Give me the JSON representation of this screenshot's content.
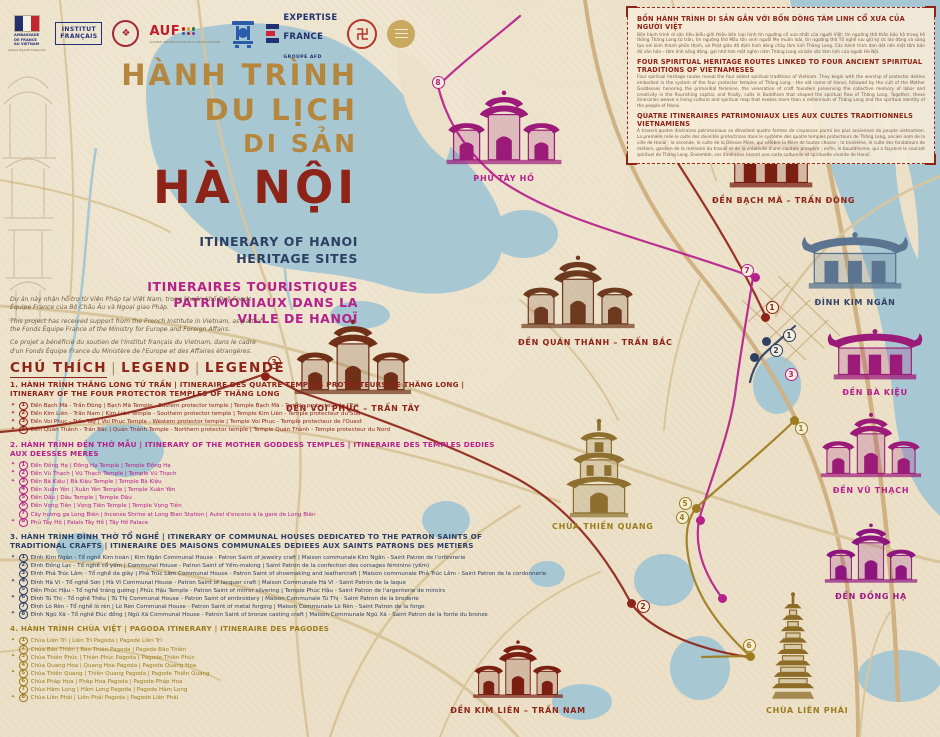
{
  "theme": {
    "parchment": "#ece1c8",
    "water": "#a7c7d3",
    "road": "#d9c59c",
    "road_major": "#cfb183",
    "red": "#8e2318",
    "magenta": "#b5208b",
    "navy": "#2d3f63",
    "gold": "#9c7c1e",
    "tan_title": "#b5873e"
  },
  "logos": {
    "ambassade_l1": "AMBASSADE",
    "ambassade_l2": "DE FRANCE",
    "ambassade_l3": "AU VIETNAM",
    "ambassade_motto": "Liberté Égalité Fraternité",
    "institut_l1": "INSTITUT",
    "institut_l2": "FRANÇAIS",
    "auf_name": "AUF",
    "auf_sub": "AGENCE UNIVERSITAIRE DE LA FRANCOPHONIE",
    "expertise_l1": "EXPERTISE",
    "expertise_l2": "FRANCE",
    "expertise_group": "GROUPE AFD"
  },
  "title_block": {
    "line1": "HÀNH TRÌNH",
    "line2": "DU LỊCH",
    "line3": "DI SẢN",
    "city": "HÀ NỘI",
    "subtitle_en1": "ITINERARY OF HANOI",
    "subtitle_en2": "HERITAGE SITES",
    "subtitle_fr1": "ITINERAIRES TOURISTIQUES",
    "subtitle_fr2": "PATRIMONIAUX DANS LA",
    "subtitle_fr3": "VILLE DE HANOÏ"
  },
  "credits": {
    "vi": "Dự án này nhận hỗ trợ từ Viện Pháp tại Việt Nam, trong khuôn khổ Quỹ Fonds Équipe France của Bộ Châu Âu và Ngoại giao Pháp.",
    "en": "This project has received support from the French Institute in Vietnam, as part of the Fonds Équipe France of the Ministry for Europe and Foreign Affairs.",
    "fr": "Ce projet a bénéficié du soutien de l'Institut français du Vietnam, dans le cadre d'un Fonds Équipe France du Ministère de l'Europe et des Affaires étrangères."
  },
  "legend": {
    "h1": "CHÚ THÍCH",
    "h2": "LEGEND",
    "h3": "LEGENDE",
    "sections": [
      {
        "color": "#8e2318",
        "title": "1. HÀNH TRÌNH THĂNG LONG TỨ TRẤN | ITINERAIRE DES QUATRE TEMPLES PROTECTEURS DE THĂNG LONG | ITINERARY OF THE FOUR PROTECTOR TEMPLES OF THĂNG LONG",
        "items": [
          {
            "n": "1",
            "star": true,
            "text": "Đền Bạch Mã - Trấn Đông | Bạch Mã Temple - Eastern protector temple | Temple Bạch Mã - Temple protecteur de l'Est"
          },
          {
            "n": "2",
            "star": true,
            "text": "Đền Kim Liên - Trấn Nam | Kim Liên Temple - Southern protector temple | Temple Kim Liên - Temple protecteur du Sud"
          },
          {
            "n": "3",
            "star": true,
            "text": "Đền Voi Phục - Trấn Tây | Voi Phục Temple - Western protector temple | Temple Voi Phục - Temple protecteur de l'Ouest"
          },
          {
            "n": "4",
            "star": true,
            "text": "Đền Quán Thánh - Trấn Bắc | Quán Thánh Temple - Northern protector temple | Temple Quán Thánh - Temple protecteur du Nord"
          }
        ]
      },
      {
        "color": "#b5208b",
        "title": "2. HÀNH TRÌNH ĐỀN THỜ MẪU | ITINERARY OF THE MOTHER GODDESS TEMPLES | ITINERAIRE DES TEMPLES DEDIES AUX DEESSES MERES",
        "items": [
          {
            "n": "1",
            "star": true,
            "text": "Đền Đồng Hạ | Đồng Hạ Temple | Temple Đồng Hạ"
          },
          {
            "n": "2",
            "star": true,
            "text": "Đền Vũ Thạch | Vũ Thạch Temple | Temple Vũ Thạch"
          },
          {
            "n": "3",
            "star": true,
            "text": "Đền Bà Kiệu | Bà Kiệu Temple | Temple Bà Kiệu"
          },
          {
            "n": "4",
            "star": false,
            "text": "Đền Xuân Yên | Xuân Yên Temple | Temple Xuân Yên"
          },
          {
            "n": "5",
            "star": false,
            "text": "Đền Dâu | Dâu Temple | Temple Dâu"
          },
          {
            "n": "6",
            "star": false,
            "text": "Đền Vọng Tiên | Vọng Tiên Temple | Temple Vọng Tiên"
          },
          {
            "n": "7",
            "star": false,
            "text": "Cây hương ga Long Biên | Incense Shrine at Long Bien Station | Autel d'encens à la gare de Long Biên"
          },
          {
            "n": "8",
            "star": true,
            "text": "Phủ Tây Hồ | Palais Tây Hồ | Tây Hồ Palace"
          }
        ]
      },
      {
        "color": "#2d3f63",
        "title": "3. HÀNH TRÌNH ĐÌNH THỜ TỔ NGHỀ | ITINERARY OF COMMUNAL HOUSES DEDICATED TO THE PATRON SAINTS OF TRADITIONAL CRAFTS | ITINERAIRE DES MAISONS COMMUNALES DEDIEES AUX SAINTS PATRONS DES METIERS",
        "items": [
          {
            "n": "1",
            "star": true,
            "text": "Đình Kim Ngân - Tổ nghề Kim hoàn | Kim Ngân Communal House - Patron Saint of jewelry craft | Maison communale Kim Ngân - Saint Patron de l'orfèvrerie"
          },
          {
            "n": "2",
            "star": false,
            "text": "Đình Đồng Lạc - Tổ nghề cổ yếm | Communal House - Patron Saint of Yếm-making | Saint Patron de la confection des corsages féminins (yếm)"
          },
          {
            "n": "3",
            "star": false,
            "text": "Đình Phả Trúc Lâm - Tổ nghề da giày | Phả Trúc Lâm Communal House - Patron Saint of shoemaking and leathercraft | Maison communale Phả Trúc Lâm - Saint Patron de la cordonnerie"
          },
          {
            "n": "4",
            "star": true,
            "text": "Đình Hà Vĩ - Tổ nghề Sơn | Hà Vĩ Communal House - Patron Saint of lacquer craft | Maison Communale Hà Vĩ - Saint Patron de la laque"
          },
          {
            "n": "5",
            "star": false,
            "text": "Đền Phúc Hậu - Tổ nghề tráng gương | Phúc Hậu Temple - Patron Saint of mirror silvering | Temple Phúc Hậu - Saint Patron de l'argenterie de miroirs"
          },
          {
            "n": "6",
            "star": true,
            "text": "Đình Tú Thị - Tổ nghề Thêu | Tú Thị Communal House - Patron Saint of embroidery | Maison Communale Tú Thị - Saint Patron de la broderie"
          },
          {
            "n": "7",
            "star": false,
            "text": "Đình Lò Rèn - Tổ nghề lò rèn | Lò Rèn Communal House - Patron Saint of metal forging | Maison Communale Lò Rèn - Saint Patron de la forge"
          },
          {
            "n": "8",
            "star": true,
            "text": "Đình Ngũ Xã - Tổ nghề Đúc đồng | Ngũ Xã Communal House - Patron Saint of bronze casting craft | Maison Communale Ngũ Xã - Saint Patron de la fonte du bronze"
          }
        ]
      },
      {
        "color": "#9c7c1e",
        "title": "4. HÀNH TRÌNH CHÙA VIỆT | PAGODA ITINERARY | ITINERAIRE DES PAGODES",
        "items": [
          {
            "n": "1",
            "star": true,
            "text": "Chùa Liên Trì | Liên Trì Pagoda | Pagode Liên Trì"
          },
          {
            "n": "2",
            "star": false,
            "text": "Chùa Báo Thiên | Báo Thiên Pagoda | Pagode Báo Thiên"
          },
          {
            "n": "3",
            "star": true,
            "text": "Chùa Thiên Phúc | Thiên Phúc Pagoda | Pagode Thiên Phúc"
          },
          {
            "n": "4",
            "star": false,
            "text": "Chùa Quang Hoa | Quang Hoa Pagoda | Pagode Quang Hoa"
          },
          {
            "n": "5",
            "star": true,
            "text": "Chùa Thiền Quang | Thiền Quang Pagoda | Pagode Thiền Quang"
          },
          {
            "n": "6",
            "star": false,
            "text": "Chùa Pháp Hoa | Pháp Hoa Pagoda | Pagode Pháp Hoa"
          },
          {
            "n": "7",
            "star": false,
            "text": "Chùa Hàm Long | Hàm Long Pagoda | Pagode Hàm Long"
          },
          {
            "n": "8",
            "star": true,
            "text": "Chùa Liên Phái | Liên Phái Pagoda | Pagode Liên Phái"
          }
        ]
      }
    ]
  },
  "info_box": {
    "title_vi": "BỐN HÀNH TRÌNH DI SẢN GẮN VỚI BỐN DÒNG TÂM LINH CỔ XƯA CỦA NGƯỜI VIỆT",
    "body_vi": "Bốn hành trình di sản tiêu biểu giới thiệu bốn loại hình tín ngưỡng cổ xưa nhất của người Việt: tín ngưỡng thờ thần bảo hộ trong hệ thống Thăng Long tứ trấn, tín ngưỡng thờ Mẫu tôn vinh người Mẹ muôn loài, tín ngưỡng thờ Tổ nghề lưu giữ ký ức lao động và sáng tạo nơi kinh thành phồn thịnh, và Phật giáo đã định hình dòng chảy tâm linh Thăng Long. Các hành trình đan dệt nên một tấm bản đồ văn hóa – tâm linh sống động, gợi nhớ hơn một nghìn năm Thăng Long và bản sắc tâm linh của người Hà Nội.",
    "title_en": "FOUR SPIRITUAL HERITAGE ROUTES LINKED TO FOUR ANCIENT SPIRITUAL TRADITIONS OF VIETNAMESES",
    "body_en": "Four spiritual heritage routes reveal the four oldest spiritual traditions of Vietnam. They begin with the worship of protector deities embodied in the system of the four protector temples of Thăng Long - the old name of Hanoi, followed by the cult of the Mother Goddesses honoring the primordial feminine, the veneration of craft founders preserving the collective memory of labor and creativity in the flourishing capital, and finally, cults in Buddhism that shaped the spiritual flow of Thăng Long. Together, these itineraries weave a living cultural and spiritual map that evokes more than a millennium of Thăng Long and the spiritual identity of the people of Hanoi.",
    "title_fr": "QUATRE ITINERAIRES PATRIMONIAUX LIES AUX CULTES TRADITIONNELS VIETNAMIENS",
    "body_fr": "À travers quatre itinéraires patrimoniaux se dévoilent quatre formes de croyances parmi les plus anciennes du peuple vietnamien. La première relie le culte des divinités protectrices dans le système des quatre temples protecteurs de Thăng Long, ancien nom de la ville de Hanoï ; la seconde, le culte de la Déesse Mère, qui célèbre la Mère de toutes choses ; la troisième, le culte des fondateurs de métiers, gardien de la mémoire du travail et de la créativité d'une capitale prospère ; enfin, le bouddhisme, qui a façonné le courant spirituel de Thăng Long. Ensemble, ces itinéraires tissent une carte culturelle et spirituelle vivante de Hanoï."
  },
  "map": {
    "sites": [
      {
        "id": "phu-tay-ho",
        "label": "PHỦ TÂY HỒ",
        "x": 443,
        "y": 85,
        "w": 122,
        "h": 87,
        "glyph": "gate3",
        "color": "#9c1a78",
        "label_color": "#b5208b"
      },
      {
        "id": "den-bach-ma",
        "label": "ĐỀN BẠCH MÃ – TRẤN ĐÔNG",
        "x": 712,
        "y": 128,
        "w": 118,
        "h": 66,
        "glyph": "hall",
        "color": "#7a1f12",
        "label_color": "#8e2318"
      },
      {
        "id": "dinh-kim-ngan",
        "label": "ĐÌNH KIM NGÂN",
        "x": 795,
        "y": 222,
        "w": 120,
        "h": 74,
        "glyph": "hall",
        "color": "#5b7590",
        "label_color": "#2d3f63"
      },
      {
        "id": "den-quan-thanh",
        "label": "ĐỀN QUÁN THÁNH – TRẤN BẮC",
        "x": 518,
        "y": 250,
        "w": 120,
        "h": 86,
        "glyph": "gate3",
        "color": "#6d3a1f",
        "label_color": "#8e2318"
      },
      {
        "id": "den-ba-kieu",
        "label": "ĐỀN BÀ KIỆU",
        "x": 822,
        "y": 320,
        "w": 106,
        "h": 66,
        "glyph": "hall",
        "color": "#9c1a78",
        "label_color": "#b5208b"
      },
      {
        "id": "den-voi-phuc",
        "label": "ĐỀN VOI PHỤC – TRẤN TÂY",
        "x": 286,
        "y": 314,
        "w": 134,
        "h": 88,
        "glyph": "gate3",
        "color": "#703018",
        "label_color": "#8e2318"
      },
      {
        "id": "den-vu-thach",
        "label": "ĐỀN VŨ THẠCH",
        "x": 816,
        "y": 408,
        "w": 110,
        "h": 76,
        "glyph": "gate3",
        "color": "#9c1a78",
        "label_color": "#b5208b"
      },
      {
        "id": "chua-thien-quang",
        "label": "CHÙA THIỀN QUANG",
        "x": 552,
        "y": 414,
        "w": 94,
        "h": 106,
        "glyph": "tower",
        "color": "#8d7030",
        "label_color": "#9c7c1e"
      },
      {
        "id": "den-dong-ha",
        "label": "ĐỀN ĐỒNG HẠ",
        "x": 822,
        "y": 518,
        "w": 98,
        "h": 72,
        "glyph": "gate3",
        "color": "#8e1580",
        "label_color": "#9c1585"
      },
      {
        "id": "chua-lien-phai",
        "label": "CHÙA LIÊN PHÁI",
        "x": 766,
        "y": 590,
        "w": 54,
        "h": 114,
        "glyph": "pagoda",
        "color": "#8d6c28",
        "label_color": "#9c7c1e"
      },
      {
        "id": "den-kim-lien",
        "label": "ĐỀN KIM LIÊN – TRẤN NAM",
        "x": 424,
        "y": 636,
        "w": 188,
        "h": 68,
        "glyph": "gate3",
        "color": "#7a1f12",
        "label_color": "#8e2318"
      }
    ],
    "markers": [
      {
        "color": "#b5208b",
        "num": "8",
        "x": 438,
        "y": 82
      },
      {
        "color": "#b5208b",
        "num": "7",
        "x": 747,
        "y": 270
      },
      {
        "color": "#8e2318",
        "num": "1",
        "x": 772,
        "y": 307
      },
      {
        "color": "#2d3f63",
        "num": "1",
        "x": 789,
        "y": 335
      },
      {
        "color": "#2d3f63",
        "num": "2",
        "x": 776,
        "y": 350
      },
      {
        "color": "#b5208b",
        "num": "3",
        "x": 791,
        "y": 374
      },
      {
        "color": "#9c7c1e",
        "num": "1",
        "x": 801,
        "y": 428
      },
      {
        "color": "#8e2318",
        "num": "3",
        "x": 274,
        "y": 362
      },
      {
        "color": "#8e2318",
        "num": "2",
        "x": 643,
        "y": 606
      },
      {
        "color": "#9c7c1e",
        "num": "4",
        "x": 682,
        "y": 517
      },
      {
        "color": "#9c7c1e",
        "num": "5",
        "x": 685,
        "y": 503
      },
      {
        "color": "#9c7c1e",
        "num": "6",
        "x": 749,
        "y": 645
      }
    ],
    "dots": [
      {
        "color": "#8e2318",
        "x": 765,
        "y": 317
      },
      {
        "color": "#8e2318",
        "x": 265,
        "y": 376
      },
      {
        "color": "#8e2318",
        "x": 631,
        "y": 603
      },
      {
        "color": "#b5208b",
        "x": 755,
        "y": 277
      },
      {
        "color": "#b5208b",
        "x": 722,
        "y": 598
      },
      {
        "color": "#b5208b",
        "x": 700,
        "y": 520
      },
      {
        "color": "#2d3f63",
        "x": 766,
        "y": 341
      },
      {
        "color": "#2d3f63",
        "x": 754,
        "y": 357
      },
      {
        "color": "#9c7c1e",
        "x": 696,
        "y": 508
      },
      {
        "color": "#9c7c1e",
        "x": 750,
        "y": 656
      },
      {
        "color": "#9c7c1e",
        "x": 794,
        "y": 420
      }
    ]
  }
}
